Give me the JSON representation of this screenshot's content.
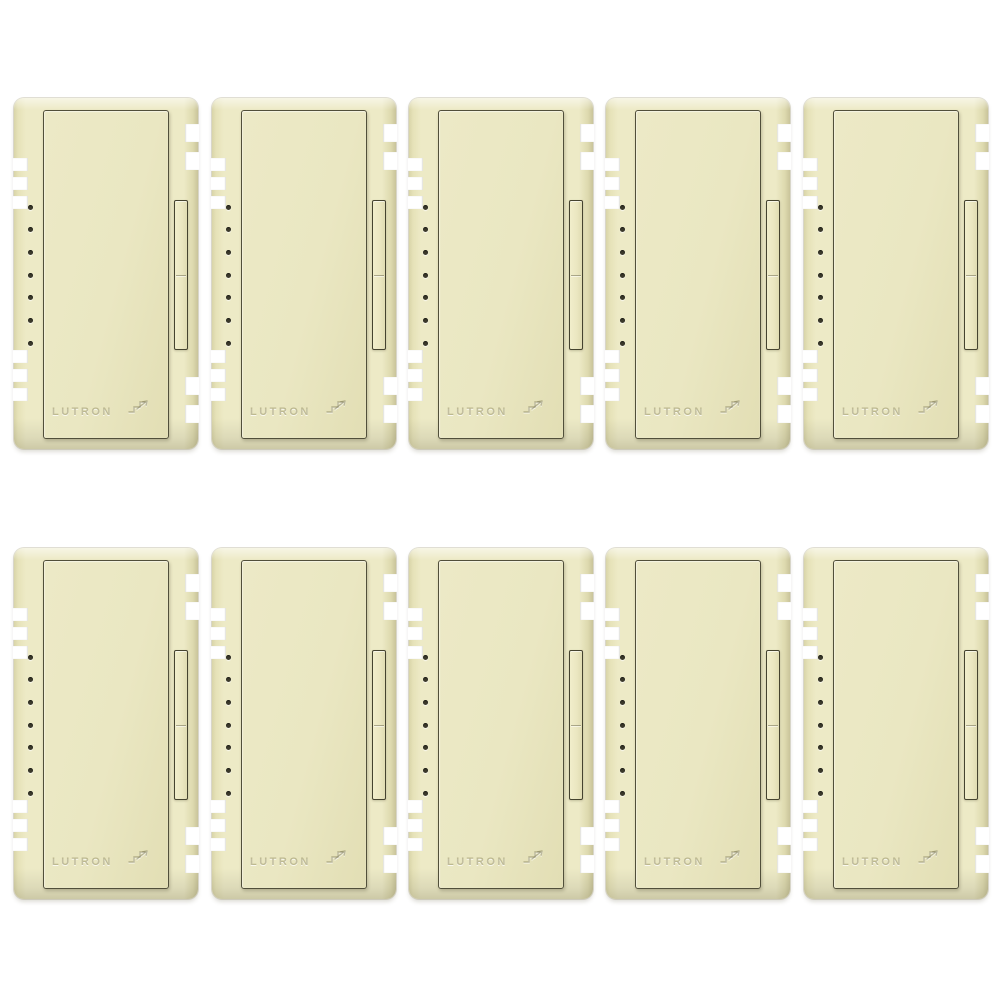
{
  "page": {
    "background_color": "#ffffff"
  },
  "product": {
    "brand_label": "LUTRON",
    "grid": {
      "rows": 2,
      "columns": 5,
      "total_units": 10
    },
    "unit": {
      "led_dot_count": 7,
      "has_slider": true,
      "icon": "stairs-dimmer-icon",
      "finish_name": "almond"
    },
    "colors": {
      "background": "#ffffff",
      "body": "#edeac6",
      "body_edge": "#d8d4a8",
      "body_dark_edge": "#c9c49a",
      "paddle": "#eae7c2",
      "outline": "#514f3a",
      "led_dot": "#3b392b"
    }
  }
}
